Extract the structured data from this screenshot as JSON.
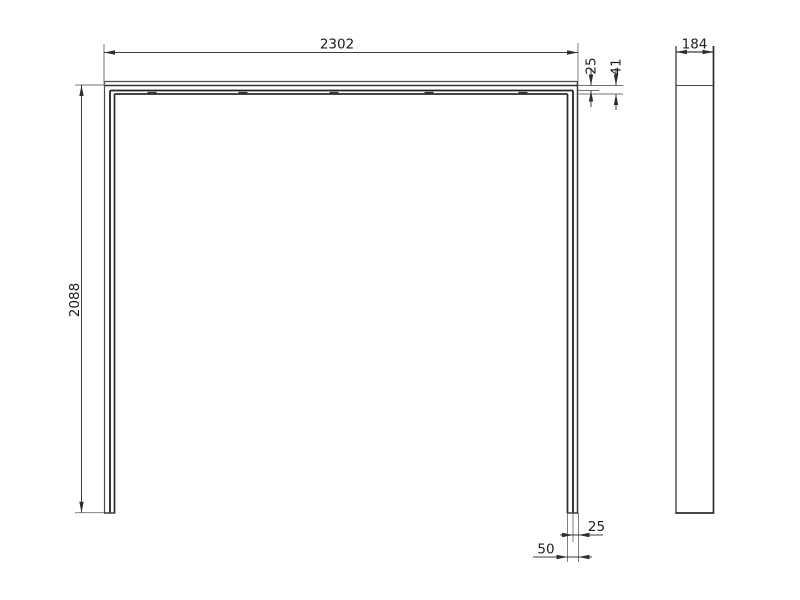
{
  "drawing": {
    "background_color": "#ffffff",
    "outline_color": "#2e2e2e",
    "dimension_line_color": "#3d3d3d",
    "text_color": "#1c1c1c"
  },
  "front_view": {
    "width_mm": "2302",
    "height_mm": "2088",
    "top_rail_front_mm": "25",
    "top_rail_total_mm": "41",
    "leg_front_mm": "25",
    "leg_width_mm": "50"
  },
  "side_view": {
    "depth_mm": "184"
  }
}
